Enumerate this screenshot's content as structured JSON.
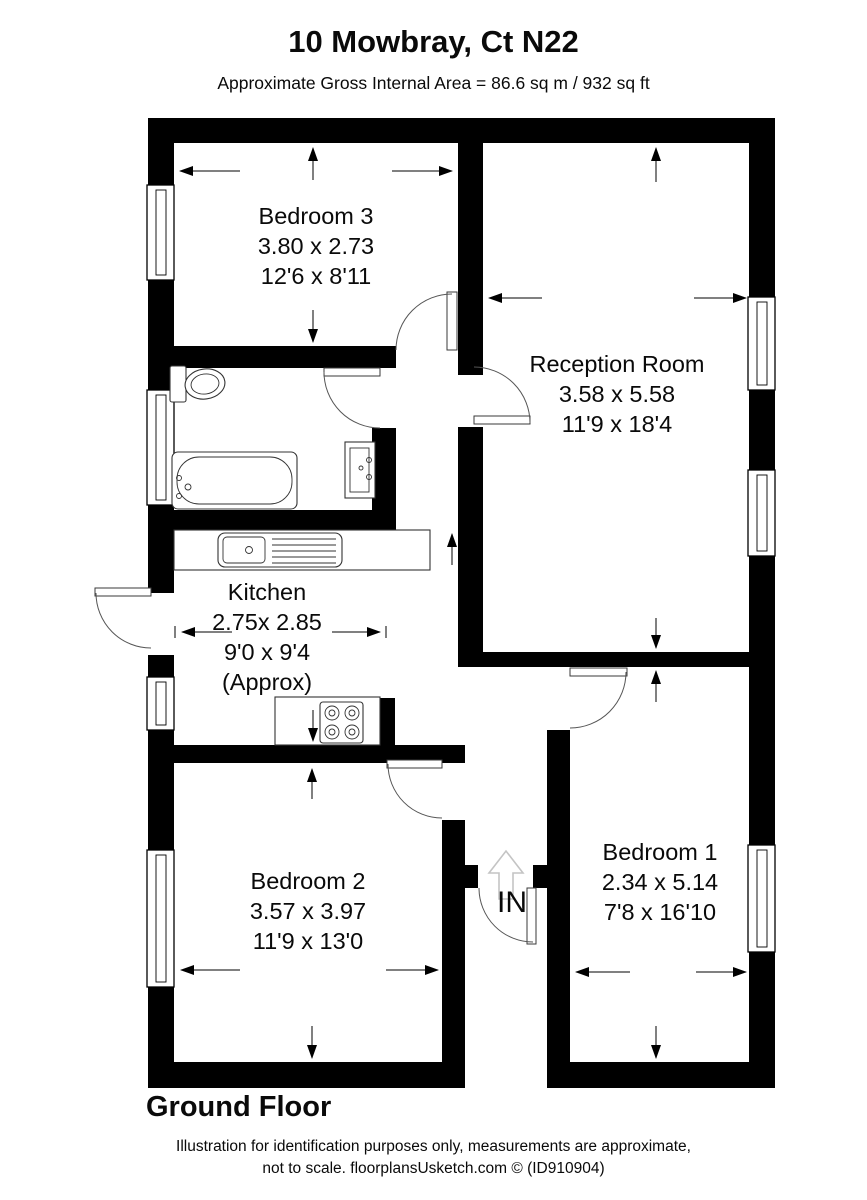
{
  "header": {
    "title": "10 Mowbray, Ct N22",
    "subtitle": "Approximate Gross Internal Area = 86.6 sq m / 932 sq ft"
  },
  "rooms": {
    "bedroom3": {
      "name": "Bedroom 3",
      "metric": "3.80 x 2.73",
      "imperial": "12'6 x 8'11"
    },
    "reception": {
      "name": "Reception Room",
      "metric": "3.58 x 5.58",
      "imperial": "11'9 x 18'4"
    },
    "kitchen": {
      "name": "Kitchen",
      "metric": "2.75x 2.85",
      "imperial": "9'0 x 9'4",
      "note": "(Approx)"
    },
    "bedroom2": {
      "name": "Bedroom 2",
      "metric": "3.57 x 3.97",
      "imperial": "11'9 x 13'0"
    },
    "bedroom1": {
      "name": "Bedroom 1",
      "metric": "2.34 x 5.14",
      "imperial": "7'8 x 16'10"
    }
  },
  "entrance": {
    "label": "IN"
  },
  "floor": {
    "label": "Ground Floor"
  },
  "footer": {
    "line1": "Illustration for identification purposes only, measurements are approximate,",
    "line2": "not to scale. floorplansUsketch.com © (ID910904)"
  },
  "colors": {
    "wall": "#000000",
    "background": "#ffffff",
    "entry_arrow": "#c4c4c4"
  }
}
